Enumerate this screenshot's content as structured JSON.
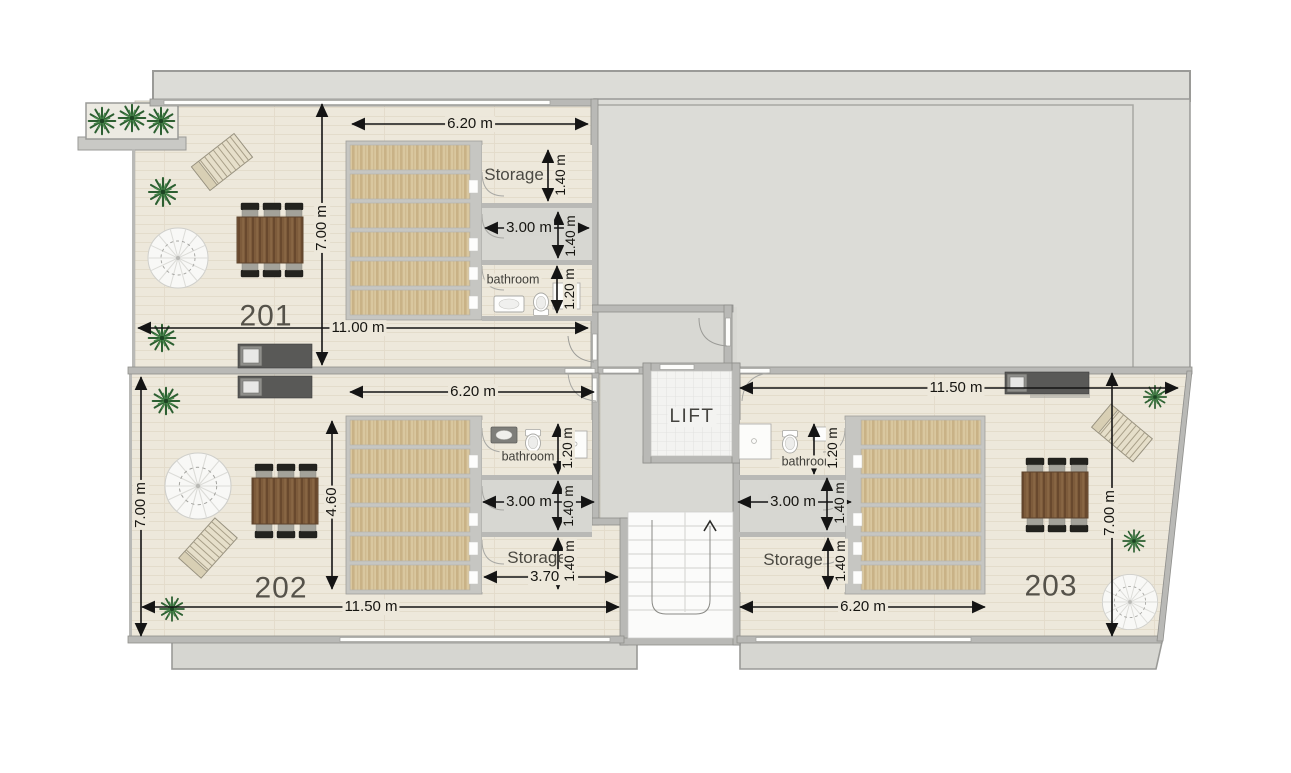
{
  "title": "Floor plan - second floor apartments",
  "colors": {
    "floor_cream": "#ede8db",
    "floor_gray": "#d6d6d1",
    "roof_gray": "#dcdcd7",
    "wall": "#b9b9b6",
    "wood_slat": "#d9c79f",
    "counter_dark": "#595957",
    "table_brown": "#7d5b3b",
    "plant_green": "#2c5f31",
    "arrow_black": "#141414"
  },
  "core": {
    "lift_label": "LIFT"
  },
  "units": {
    "u201": {
      "number": "201",
      "dim_top": "6.20 m",
      "dim_left": "7.00 m",
      "dim_bottom": "11.00 m",
      "storage_label": "Storage",
      "storage_height": "1.40 m",
      "hall_width": "3.00 m",
      "hall_height": "1.40 m",
      "bathroom_label": "bathroom",
      "bathroom_height": "1.20 m"
    },
    "u202": {
      "number": "202",
      "dim_top": "6.20 m",
      "dim_left": "7.00 m",
      "dim_inner": "4.60",
      "dim_bottom": "11.50 m",
      "bathroom_label": "bathroom",
      "bathroom_height": "1.20 m",
      "hall_width": "3.00 m",
      "hall_height": "1.40 m",
      "storage_label": "Storage",
      "storage_width": "3.70 m",
      "storage_height": "1.40 m"
    },
    "u203": {
      "number": "203",
      "dim_top": "11.50 m",
      "dim_right": "7.00 m",
      "bathroom_label": "bathroom",
      "bathroom_height": "1.20 m",
      "hall_width": "3.00 m",
      "hall_height": "1.40 m",
      "storage_label": "Storage",
      "storage_height": "1.40 m",
      "dim_bottom": "6.20 m"
    }
  }
}
